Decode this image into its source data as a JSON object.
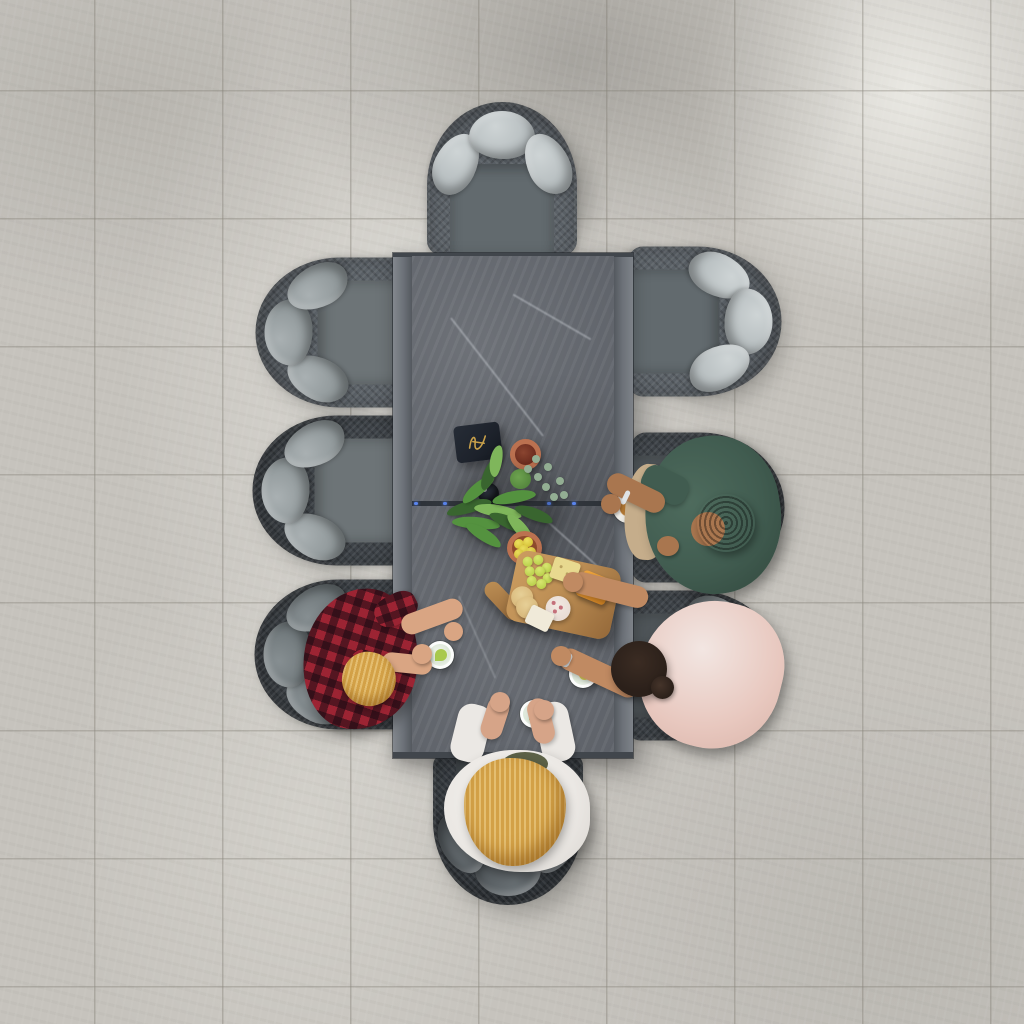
{
  "scene": {
    "description": "Overhead drone photo of an 8-seat grey rattan garden dining set on large light-grey porcelain patio tiles; four people sit around a rectangular slate-top aluminium table sharing drinks and a wooden cheese board with a plant centrepiece",
    "setting": "outdoor patio, bright sunlight with soft diagonal shadows",
    "people_count": 4,
    "table": {
      "shape": "rectangular extending table",
      "top": "grey slate-effect ceramic with white veining and centre extension seam",
      "frame": "grey aluminium side rails"
    },
    "chairs": [
      {
        "id": "chair-top",
        "side": "north",
        "occupied": false
      },
      {
        "id": "chair-left-1",
        "side": "west",
        "occupied": false
      },
      {
        "id": "chair-left-2",
        "side": "west",
        "occupied": false
      },
      {
        "id": "chair-left-3",
        "side": "west",
        "occupied": true
      },
      {
        "id": "chair-right-1",
        "side": "east",
        "occupied": false
      },
      {
        "id": "chair-right-2",
        "side": "east",
        "occupied": true
      },
      {
        "id": "chair-right-3",
        "side": "east",
        "occupied": true
      },
      {
        "id": "chair-bottom",
        "side": "south",
        "occupied": true
      }
    ],
    "people": [
      {
        "id": "man-plaid",
        "seat": "chair-left-3",
        "hair": "blonde",
        "clothing": "red-black buffalo plaid shirt",
        "action": "holding glass with lime, arm resting on table"
      },
      {
        "id": "man-green",
        "seat": "chair-right-2",
        "hair": "dark curly",
        "clothing": "dark green shirt, khaki shorts, silver bracelet",
        "action": "reaching for latte cup"
      },
      {
        "id": "woman-pink",
        "seat": "chair-right-3",
        "hair": "dark with low bun",
        "clothing": "light pink top, wristwatch",
        "action": "reaching across table to cheese board"
      },
      {
        "id": "woman-white",
        "seat": "chair-bottom",
        "hair": "long blonde",
        "clothing": "white shirt over olive top",
        "action": "both hands on table holding a drink"
      }
    ],
    "tabletop_items": [
      "navy menu folder with gold monogram",
      "terracotta saucer with dried red botanicals",
      "small dark glass jar",
      "potted fern with eucalyptus sprigs",
      "terracotta pot of yellow craspedia flowers",
      "wooden paddle cheese board with green grapes, crackers, cheddar block, salami and soft cheese",
      "three glasses with lime and lemon",
      "white latte cup"
    ]
  },
  "colors": {
    "floor_base": "#cfccc6",
    "tile_line": "#a8a49b",
    "wicker_lit": "#5b6167",
    "wicker_dark": "#3e4348",
    "wicker_deep": "#363b40",
    "cushion_a": "#b4bbbd",
    "cushion_a_hi": "#ced4d5",
    "seat_a": "#626a6e",
    "cushion_b": "#8d9597",
    "cushion_b_hi": "#a9b0b2",
    "seat_b": "#6d7477",
    "cushion_c": "#6d7578",
    "cushion_c_hi": "#868e91",
    "seat_c": "#4f5559",
    "cushion_d": "#545a5e",
    "cushion_d_hi": "#6b7276",
    "seat_d": "#454b4f",
    "edge_dark": "#41464c",
    "slate": "#5d6168",
    "seam_blue": "#5b86f0",
    "terracotta": "#bb7150",
    "terracotta_deep": "#8e4a2c",
    "berry": "#6b2c1f",
    "plant_dark": "#39652f",
    "plant_mid": "#54923f",
    "plant_light": "#7fb65b",
    "euc": "#93ae93",
    "flower_yellow": "#d7c33a",
    "wood": "#bd8f55",
    "wood_dark": "#95693a",
    "cracker": "#e8d98f",
    "cracker_round": "#d9b97c",
    "cheddar": "#e0912f",
    "salami": "#e8dcd4",
    "salami_fleck": "#c4707a",
    "cheese_white": "#f0ead9",
    "grape": "#bcd24e",
    "menu_navy": "#1d222b",
    "menu_gold": "#c8a04a",
    "glass_body": "#dde8d9",
    "lime": "#a8c94e",
    "lemon": "#d6cc5a",
    "latte": "#b77b36",
    "plaid_red": "#9c2433",
    "plaid_shadow": "rgba(26,10,18,0.55)",
    "shirt_green": "#415c50",
    "shirt_green_hi": "#4e6b5d",
    "khaki": "#c5ad8b",
    "skin_a": "#d9a583",
    "skin_b": "#a9764f",
    "skin_c": "#c08a62",
    "skin_d": "#d6a488",
    "hair_blonde": "#d3a147",
    "hair_dark": "#1f1711",
    "hair_brown": "#2b201a",
    "shirt_white": "#ebe8e4",
    "blush": "#e8c8bf",
    "olive": "#5c6147",
    "silver": "#dfe3e6"
  }
}
